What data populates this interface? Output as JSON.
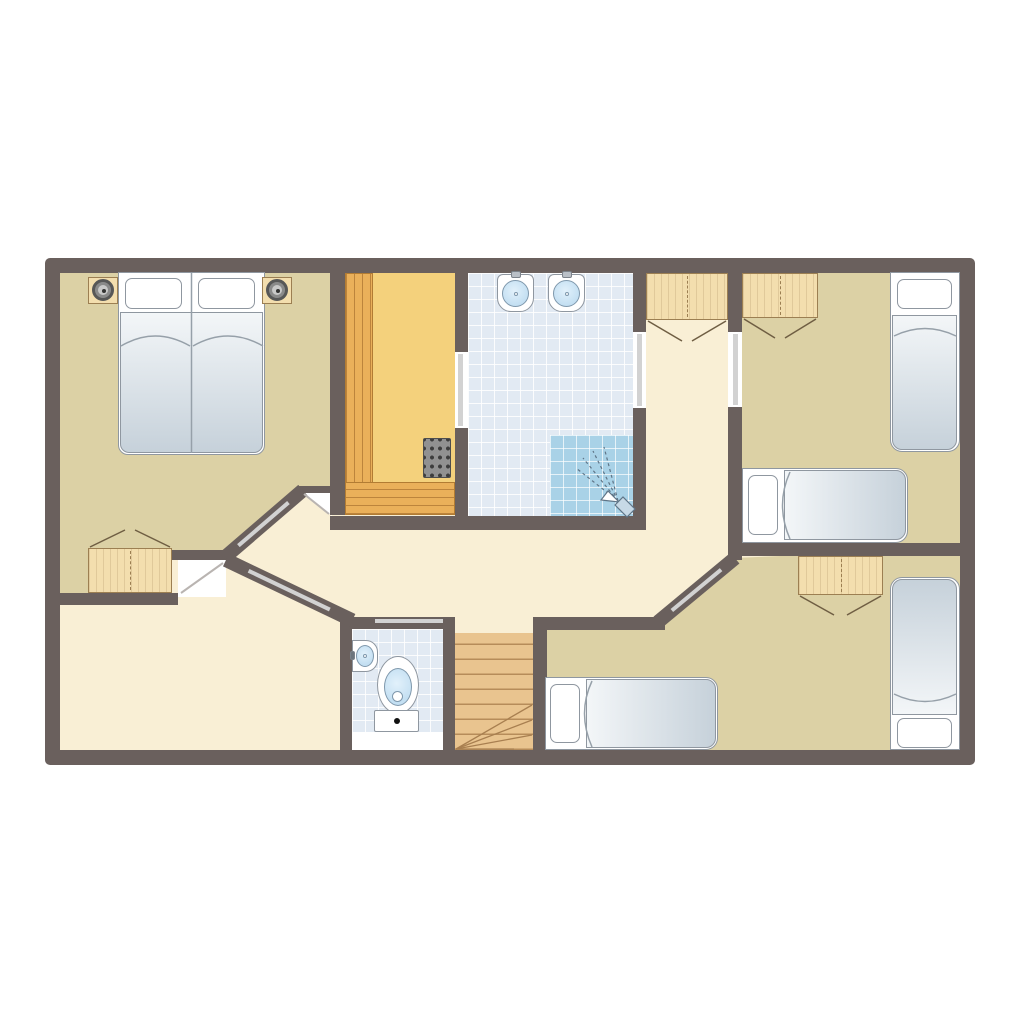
{
  "app": {
    "type": "floor-plan",
    "view": "upper-floor-layout"
  },
  "palette": {
    "canvas": "#ffffff",
    "wall": "#6a605d",
    "hall_floor": "#f9efd5",
    "bedroom_floor": "#dcd1a5",
    "sauna_floor": "#f4d17c",
    "sauna_bench": "#eab05a",
    "sauna_bench_line": "#b27c33",
    "wood": "#f3deae",
    "wood_line": "#9c7f52",
    "stairs_wood": "#e9c48f",
    "stairs_line": "#a87f50",
    "tile": "#e2eaf3",
    "tile_shower": "#a9d2e7",
    "fixture_outline": "#8f97a0",
    "water": "#c3dff2",
    "glass": "#d2d2d2",
    "duvet_light": "#f3f6f8",
    "duvet_dark": "#c6d1da",
    "heater": "#919191",
    "door_leaf": "#b9b4b1"
  },
  "rooms": [
    {
      "name": "bedroom-top-left",
      "floor": "tan",
      "furniture": [
        "double-bed",
        "nightstand-with-lamp-left",
        "nightstand-with-lamp-right",
        "wardrobe"
      ]
    },
    {
      "name": "sauna",
      "floor": "yellow",
      "furniture": [
        "bench-left",
        "bench-bottom",
        "sauna-heater"
      ],
      "doors": [
        "glass-door-to-bathroom"
      ]
    },
    {
      "name": "bathroom",
      "floor": "blue-tile",
      "furniture": [
        "washbasin-left",
        "washbasin-right",
        "shower-corner"
      ],
      "doors": [
        "glass-door-to-hall"
      ]
    },
    {
      "name": "hallway",
      "floor": "cream",
      "furniture": [
        "built-in-closet"
      ],
      "doors": [
        "diagonal-glass-door-bedroom-top-left",
        "diagonal-glass-door-bottom-left-room",
        "diagonal-glass-door-bedroom-bottom-right"
      ]
    },
    {
      "name": "bedroom-top-right",
      "floor": "tan",
      "furniture": [
        "wardrobe",
        "single-bed-vertical",
        "single-bed-horizontal"
      ],
      "doors": [
        "glass-door-to-hall"
      ]
    },
    {
      "name": "bedroom-bottom-right",
      "floor": "tan",
      "furniture": [
        "wardrobe",
        "single-bed-vertical",
        "single-bed-horizontal"
      ]
    },
    {
      "name": "wc",
      "floor": "blue-tile",
      "furniture": [
        "hand-basin",
        "toilet"
      ]
    },
    {
      "name": "staircase",
      "floor": "wood",
      "furniture": [
        "winder-stairs"
      ]
    },
    {
      "name": "room-bottom-left",
      "floor": "cream",
      "furniture": []
    }
  ]
}
